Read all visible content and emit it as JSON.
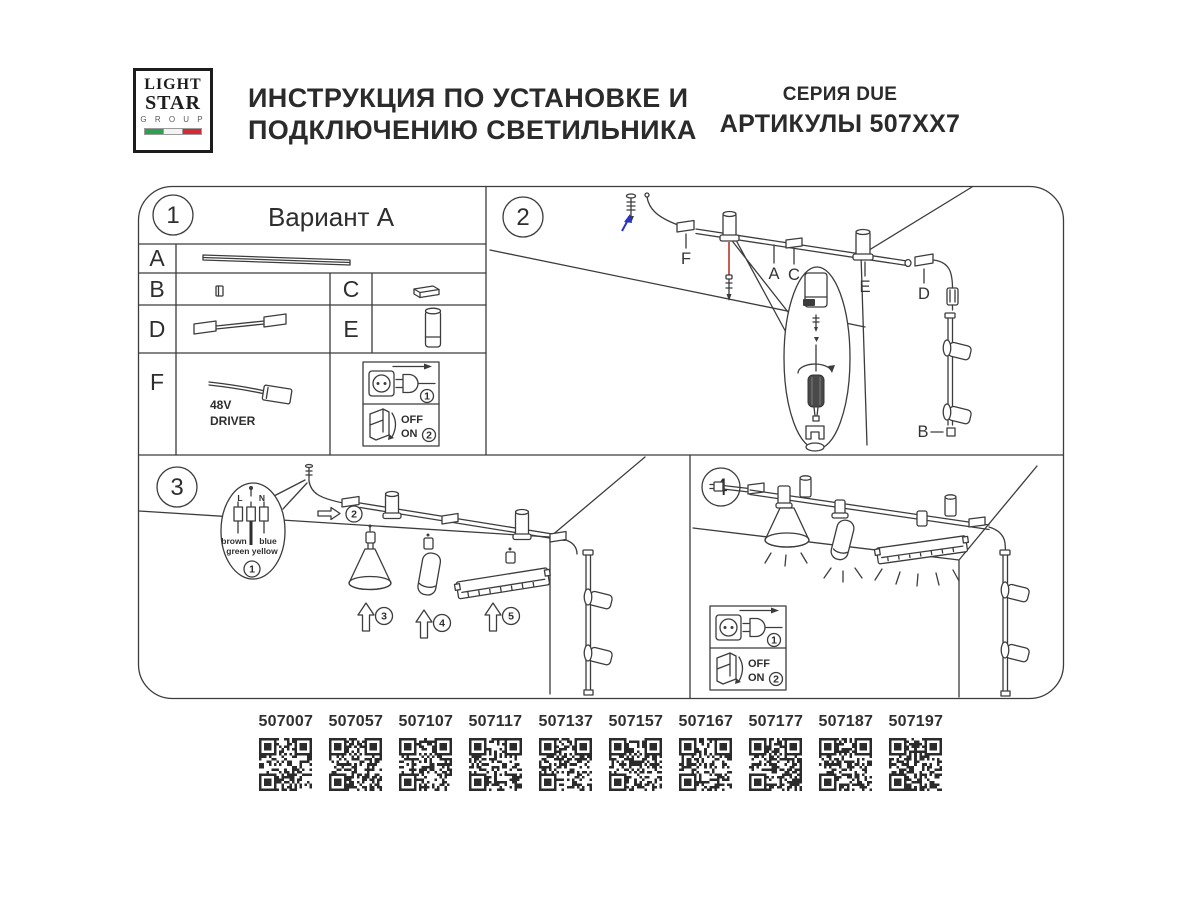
{
  "logo": {
    "line1": "LIGHT",
    "line2": "STAR",
    "line3": "G R O U P"
  },
  "header": {
    "title_line1": "ИНСТРУКЦИЯ ПО УСТАНОВКЕ И",
    "title_line2": "ПОДКЛЮЧЕНИЮ СВЕТИЛЬНИКА",
    "series": "СЕРИЯ DUE",
    "articles": "АРТИКУЛЫ 507XX7"
  },
  "panel1": {
    "number": "1",
    "title": "Вариант А",
    "rows": {
      "a": "A",
      "b": "B",
      "c": "C",
      "d": "D",
      "e": "E",
      "f": "F"
    },
    "driver": {
      "line1": "48V",
      "line2": "DRIVER"
    },
    "power": {
      "step_plug": "1",
      "step_switch": "2",
      "off": "OFF",
      "on": "ON"
    }
  },
  "panel2": {
    "number": "2",
    "labels": {
      "f": "F",
      "a": "A",
      "c": "C",
      "e": "E",
      "d": "D",
      "b": "B"
    }
  },
  "panel3": {
    "number": "3",
    "wiring": {
      "l": "L",
      "n": "N",
      "wire_left": "brown",
      "wire_right": "blue",
      "wire_bottom": "green yellow",
      "step": "1"
    },
    "steps": {
      "track": "2",
      "cone": "3",
      "cylinder": "4",
      "linear": "5"
    }
  },
  "panel4": {
    "number": "4",
    "power": {
      "step_plug": "1",
      "step_switch": "2",
      "off": "OFF",
      "on": "ON"
    }
  },
  "qr_codes": [
    "507007",
    "507057",
    "507107",
    "507117",
    "507137",
    "507157",
    "507167",
    "507177",
    "507187",
    "507197"
  ],
  "colors": {
    "ink": "#2e2e2e",
    "line": "#3c3c3c",
    "accent_red": "#c4604f",
    "accent_blue": "#2734c4",
    "flag_green": "#2f9e4f",
    "flag_white": "#f2f2f2",
    "flag_red": "#d22b35"
  }
}
